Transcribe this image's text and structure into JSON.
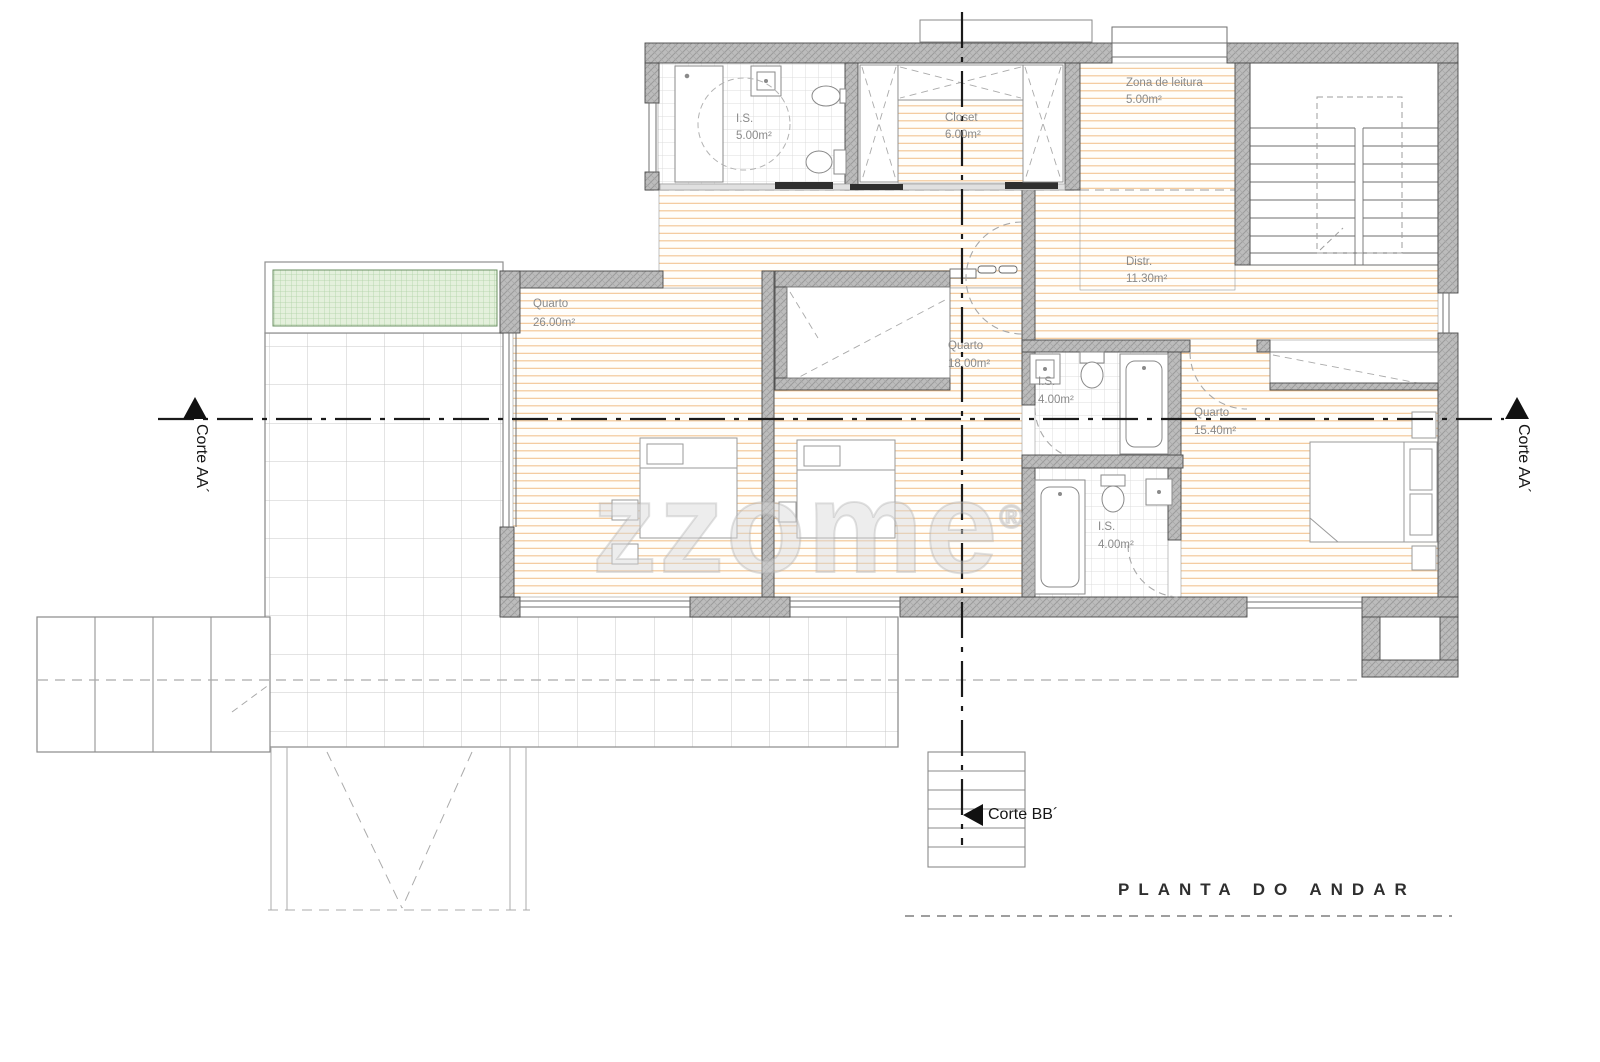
{
  "title": "PLANTA DO ANDAR",
  "watermark": {
    "text": "zzome",
    "reg": "®"
  },
  "sections": {
    "aa_left": "Corte AA´",
    "aa_right": "Corte AA´",
    "bb": "Corte BB´"
  },
  "rooms": [
    {
      "name": "I.S.",
      "area": "5.00m²"
    },
    {
      "name": "Closet",
      "area": "6.00m²"
    },
    {
      "name": "Zona de leitura",
      "area": "5.00m²"
    },
    {
      "name": "Distr.",
      "area": "11.30m²"
    },
    {
      "name": "Quarto",
      "area": "26.00m²"
    },
    {
      "name": "Quarto",
      "area": "18.00m²"
    },
    {
      "name": "I.S.",
      "area": "4.00m²"
    },
    {
      "name": "Quarto",
      "area": "15.40m²"
    },
    {
      "name": "I.S.",
      "area": "4.00m²"
    }
  ],
  "colors": {
    "wall": "#b9b9b9",
    "wall_hatch": "#9b9b9b",
    "wood_line": "#f2c593",
    "tile_line": "#dcdcdc",
    "terrace_line": "#c9c9c9",
    "planter_fill": "#e4f0dc",
    "planter_line": "#aed2a4",
    "section_line": "#1a1a1a",
    "label_text": "#8a8a8a"
  }
}
